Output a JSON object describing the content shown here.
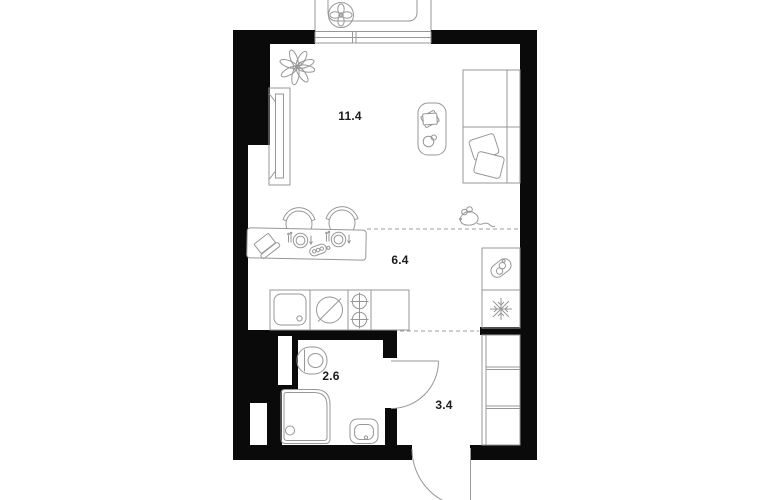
{
  "plan": {
    "type": "studio-apartment-floor-plan",
    "colors": {
      "wall": "#0a0a0a",
      "furniture_line": "#979797",
      "label": "#1c1c1c",
      "background": "#ffffff"
    },
    "rooms": {
      "living": {
        "area_label": "11.4"
      },
      "kitchen": {
        "area_label": "6.4"
      },
      "bathroom": {
        "area_label": "2.6"
      },
      "hallway": {
        "area_label": "3.4"
      }
    },
    "icons": {
      "fan-icon": "svg-fan-4-petals",
      "plant-icon": "svg-leaf-scribble",
      "window-icon": "svg-triple-line-glazing",
      "wardrobe-icon": "svg-rect-with-door-panel",
      "sofa-bed-icon": "svg-rect-with-mattress-lines",
      "pillow-icon": "svg-rotated-rounded-squares",
      "coffee-table-icon": "svg-rounded-pill-table",
      "book-icon": "svg-overlapping-tilted-rects",
      "cup-icon": "svg-circle-with-handle",
      "mouse-doodle-icon": "svg-mouse-with-tail",
      "chair-icon": "svg-circle-with-backrest-arc",
      "dining-table-icon": "svg-rounded-rect",
      "laptop-icon": "svg-open-laptop",
      "place-setting-icon": "svg-plate-fork-knife",
      "remote-icon": "svg-capsule-three-buttons",
      "sink-icon": "svg-rounded-basin-with-drain",
      "induction-hob-icon": "svg-circle-with-slash",
      "burner-icon": "svg-crossed-circles",
      "boiler-icon": "svg-tilted-capsule-coils",
      "snowflake-icon": "svg-snowflake",
      "toilet-icon": "svg-stadium-with-bowl",
      "shower-icon": "svg-rounded-square-with-drain",
      "washbasin-icon": "svg-nested-rounded-rects",
      "closet-icon": "svg-shelved-rect",
      "door-swing-icon": "svg-quarter-arc",
      "zone-divider": "dashed-line"
    }
  }
}
